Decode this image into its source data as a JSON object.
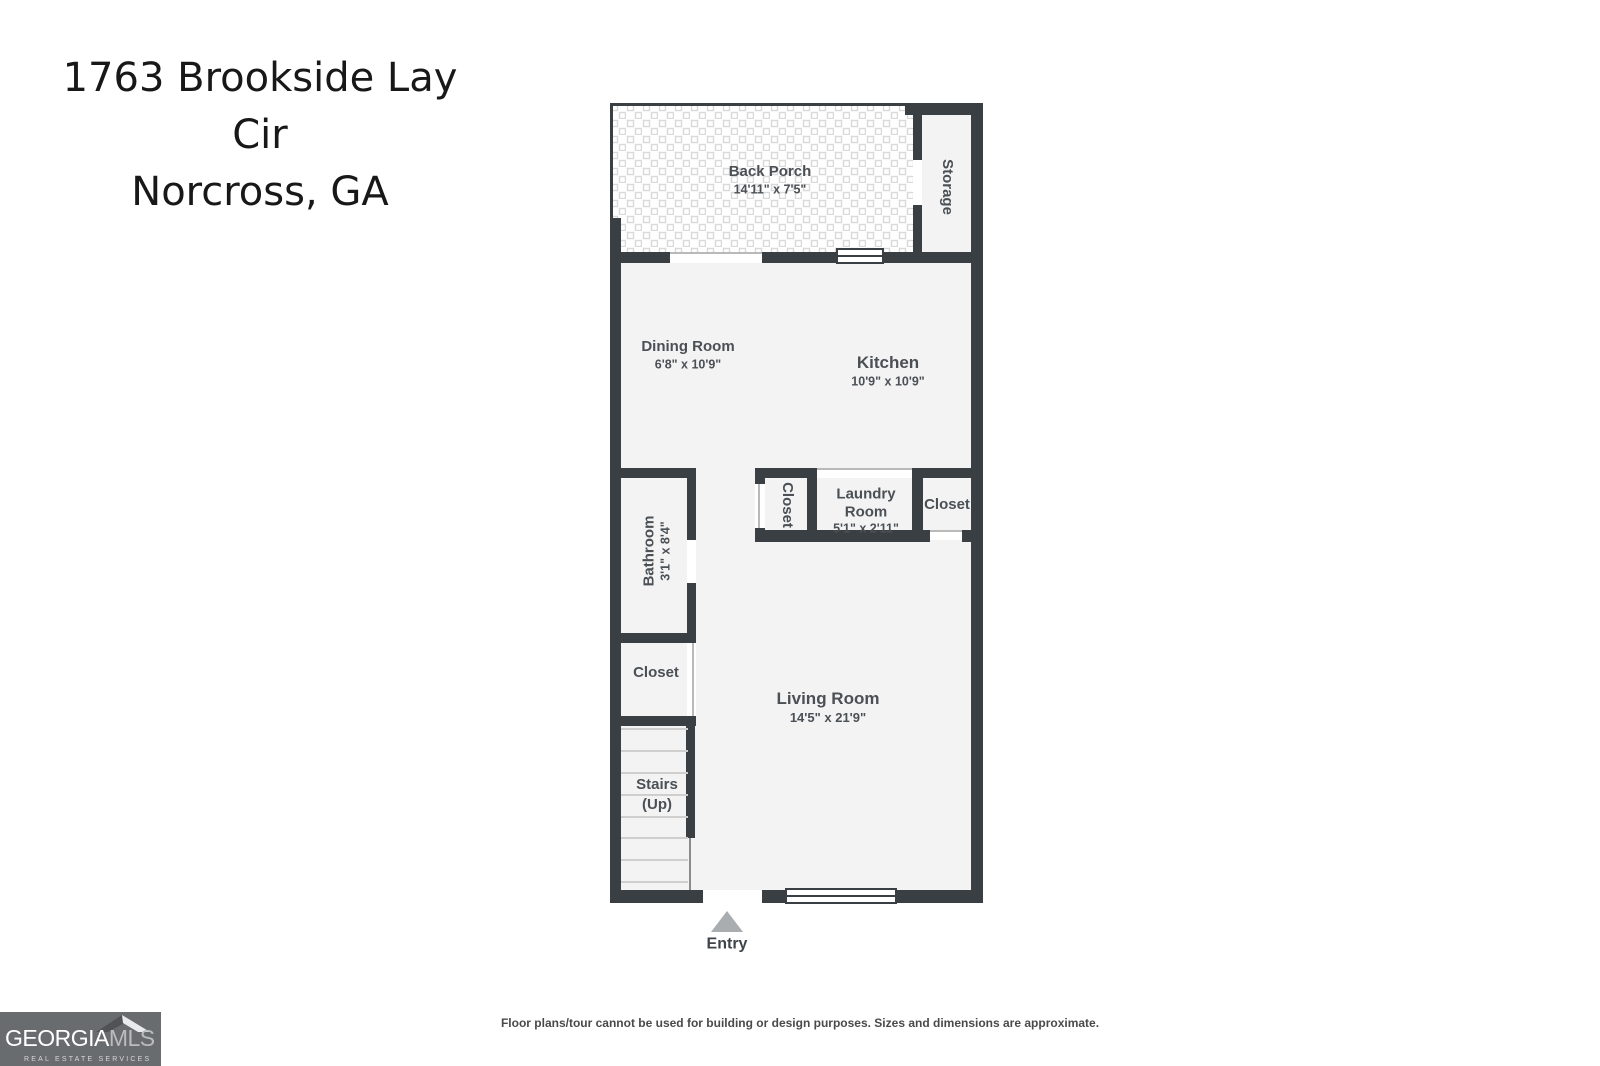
{
  "title": {
    "line1": "1763 Brookside Lay Cir",
    "line2": "Norcross, GA"
  },
  "plan": {
    "back_porch": {
      "name": "Back Porch",
      "dims": "14'11\" x 7'5\""
    },
    "storage": {
      "name": "Storage"
    },
    "dining_room": {
      "name": "Dining Room",
      "dims": "6'8\" x 10'9\""
    },
    "kitchen": {
      "name": "Kitchen",
      "dims": "10'9\" x 10'9\""
    },
    "hall_closet": {
      "name": "Closet"
    },
    "laundry_room": {
      "name": "Laundry Room",
      "dims": "5'1\" x 2'11\""
    },
    "right_closet": {
      "name": "Closet"
    },
    "bathroom": {
      "name": "Bathroom",
      "dims": "3'1\" x 8'4\""
    },
    "left_closet": {
      "name": "Closet"
    },
    "stairs": {
      "name": "Stairs (Up)"
    },
    "living_room": {
      "name": "Living Room",
      "dims": "14'5\" x 21'9\""
    },
    "entry": {
      "label": "Entry"
    }
  },
  "footer": {
    "disclaimer": "Floor plans/tour cannot be used for building or design purposes. Sizes and dimensions are approximate."
  },
  "logo": {
    "brand_primary": "GEORGIA",
    "brand_secondary": "MLS",
    "tagline": "REAL ESTATE SERVICES"
  },
  "colors": {
    "wall": "#3a3f44",
    "room_fill": "#f3f3f4",
    "label_text": "#4b5055",
    "entry_arrow": "#a9adb0",
    "logo_background": "#696c6f"
  }
}
